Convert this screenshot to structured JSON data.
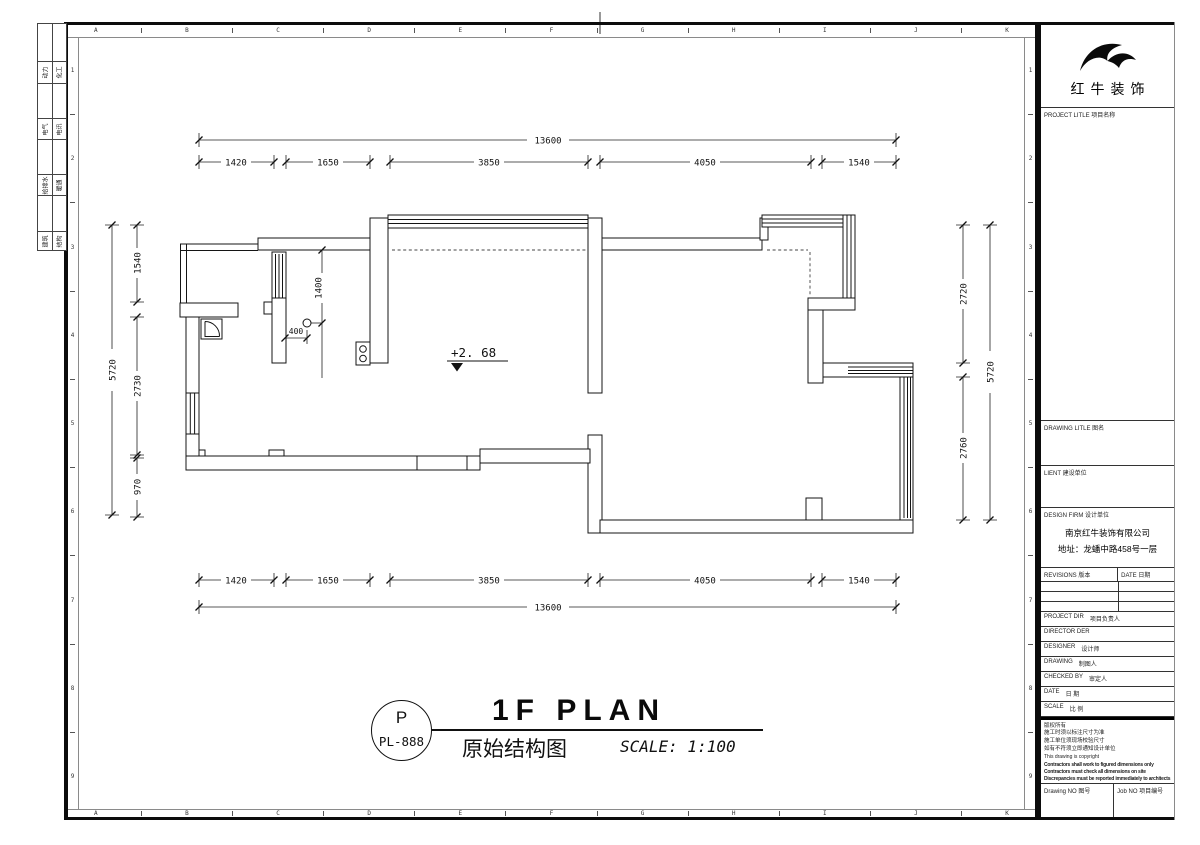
{
  "sheet": {
    "frame": {
      "cols": [
        "A",
        "B",
        "C",
        "D",
        "E",
        "F",
        "G",
        "H",
        "I",
        "J",
        "K"
      ],
      "rows": [
        "1",
        "2",
        "3",
        "4",
        "5",
        "6",
        "7",
        "8",
        "9"
      ]
    },
    "discipline_strip": {
      "rows": [
        {
          "left": "动力",
          "right": "化工"
        },
        {
          "left": "电气",
          "right": "电讯"
        },
        {
          "left": "给排水",
          "right": "暖通"
        },
        {
          "left": "建筑",
          "right": "结构"
        }
      ]
    }
  },
  "plan": {
    "dims": {
      "top_total": "13600",
      "top_segments": [
        "1420",
        "1650",
        "3850",
        "4050",
        "1540"
      ],
      "bottom_segments": [
        "1420",
        "1650",
        "3850",
        "4050",
        "1540"
      ],
      "bottom_total": "13600",
      "left_total": "5720",
      "left_segments": [
        "1540",
        "2730",
        "970"
      ],
      "right_segments": [
        "2720",
        "2760"
      ],
      "right_total": "5720",
      "interior_v": "1400",
      "interior_h": "400"
    },
    "level_annotation": "+2. 68"
  },
  "title_area": {
    "drawing_code_top": "P",
    "drawing_code_bottom": "PL-888",
    "title_en": "1F PLAN",
    "title_cn": "原始结构图",
    "scale_note": "SCALE: 1:100"
  },
  "title_block": {
    "logo_icon": "bull-horn-swoosh",
    "brand": "红牛装饰",
    "project_title_label": "PROJECT LITLE  项目名称",
    "drawing_title_label": "DRAWING LITLE  图名",
    "client_label": "LIENT  建设单位",
    "design_firm_label": "DESIGN FIRM  设计单位",
    "design_firm_name": "南京红牛装饰有限公司",
    "design_firm_address": "地址：龙蟠中路458号一层",
    "revisions_label": "REVISIONS  版本",
    "date_col_label": "DATE  日期",
    "rows": [
      {
        "en": "PROJECT DIR",
        "cn": "项目负责人"
      },
      {
        "en": "DIRECTOR DER",
        "cn": ""
      },
      {
        "en": "DESIGNER",
        "cn": "设计师"
      },
      {
        "en": "DRAWING",
        "cn": "制图人"
      },
      {
        "en": "CHECKED BY",
        "cn": "审定人"
      },
      {
        "en": "DATE",
        "cn": "日 期"
      },
      {
        "en": "SCALE",
        "cn": "比 例"
      }
    ],
    "copyright": {
      "cn_lines": [
        "版权所有",
        "施工时须以标注尺寸为准",
        "施工单位须现场校验尺寸",
        "如有不符须立即通知设计单位"
      ],
      "en_small": "This drawing is copyright",
      "en_bold_lines": [
        "Contractors shall work to figured dimensions only",
        "Contractors must check all dimensions on site",
        "Discrepancies must be reported immediately to architects"
      ]
    },
    "drawing_no_label": "Drawing NO 图号",
    "job_no_label": "Job NO 项目编号"
  },
  "colors": {
    "line": "#141414",
    "paper": "#ffffff"
  }
}
